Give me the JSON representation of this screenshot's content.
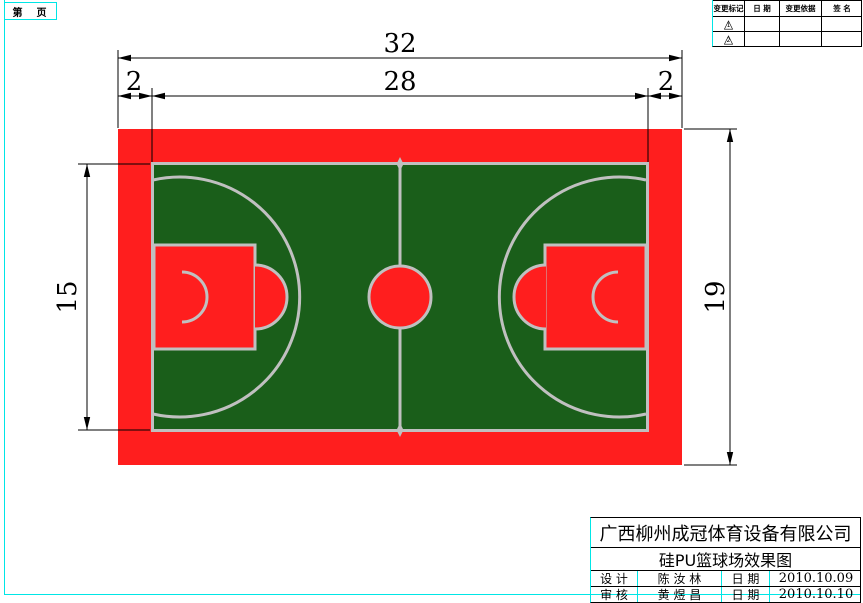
{
  "colors": {
    "surround": "#FF1E1E",
    "field": "#1A5E1A",
    "courtline": "#C0C0C0",
    "frame": "#00E6E6",
    "ink": "#000000"
  },
  "page": {
    "sheet_label": "第　页"
  },
  "revision_table": {
    "headers": [
      "变更标记",
      "日 期",
      "变更依据",
      "签 名"
    ],
    "rows": [
      {
        "mark_icon": "triangle",
        "mark": "1",
        "date": "",
        "basis": "",
        "signature": ""
      },
      {
        "mark_icon": "triangle",
        "mark": "2",
        "date": "",
        "basis": "",
        "signature": ""
      }
    ]
  },
  "drawing": {
    "dimensions": {
      "overall_width": "32",
      "inner_width": "28",
      "left_margin": "2",
      "right_margin": "2",
      "field_height": "15",
      "overall_height": "19"
    }
  },
  "title_block": {
    "company": "广西柳州成冠体育设备有限公司",
    "drawing_title": "硅PU篮球场效果图",
    "rows": [
      {
        "role": "设 计",
        "name": "陈 汝 林",
        "date_label": "日 期",
        "date": "2010.10.09"
      },
      {
        "role": "审 核",
        "name": "黄 煜 昌",
        "date_label": "日 期",
        "date": "2010.10.10"
      }
    ]
  }
}
